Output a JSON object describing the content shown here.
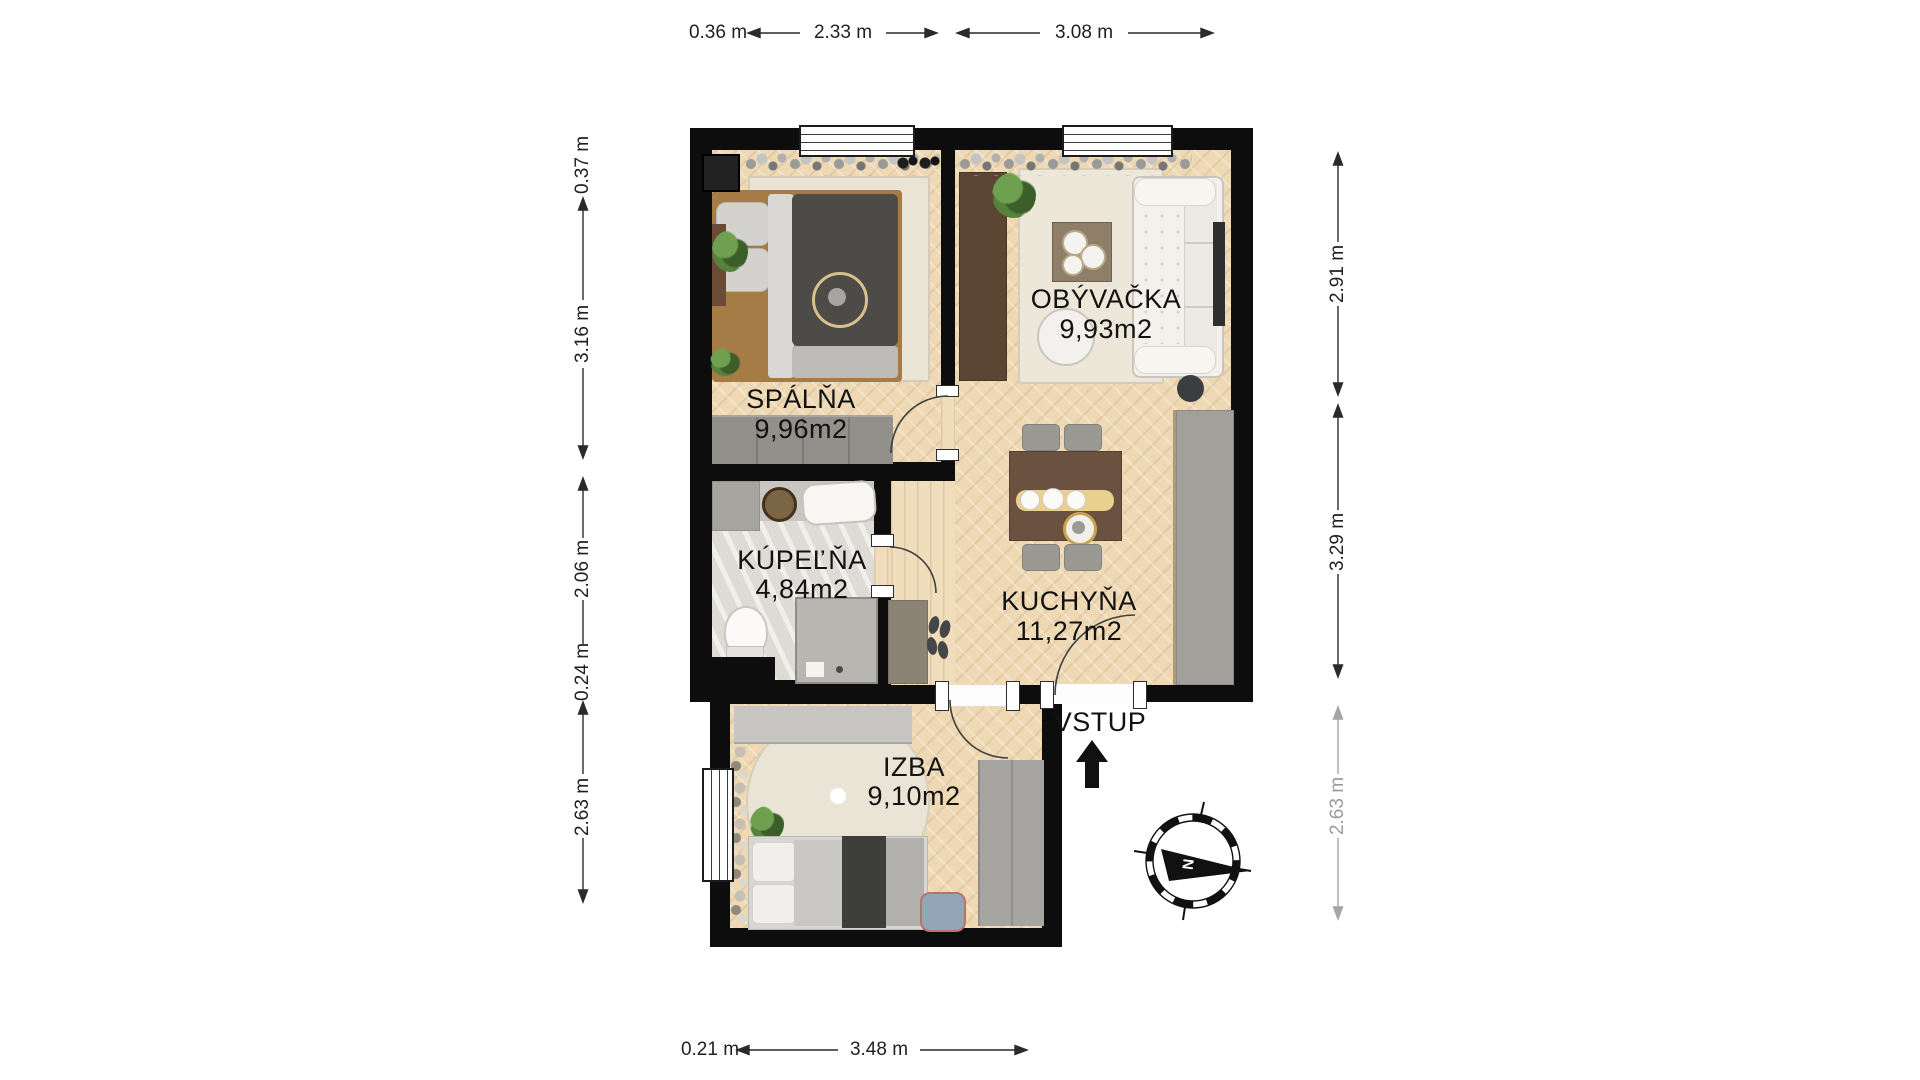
{
  "plan": {
    "rooms": [
      {
        "name": "SPÁLŇA",
        "area": "9,96m2"
      },
      {
        "name": "OBÝVAČKA",
        "area": "9,93m2"
      },
      {
        "name": "KÚPEĽŇA",
        "area": "4,84m2"
      },
      {
        "name": "KUCHYŇA",
        "area": "11,27m2"
      },
      {
        "name": "IZBA",
        "area": "9,10m2"
      }
    ],
    "entrance_label": "VSTUP",
    "compass": {
      "north_label": "N"
    }
  },
  "dimensions": {
    "top": [
      "0.36 m",
      "2.33 m",
      "3.08 m"
    ],
    "left": [
      "0.37 m",
      "3.16 m",
      "2.06 m",
      "0.24 m",
      "2.63 m"
    ],
    "right": [
      "2.91 m",
      "3.29 m",
      "2.63 m"
    ],
    "bottom": [
      "0.21 m",
      "3.48 m"
    ]
  },
  "colors": {
    "wall": "#0d0d0d",
    "floor_wood": "#eed9b4",
    "bathroom_tile": "#dedbd5",
    "accent_gold": "#d9c08c",
    "dim_gray": "#9b9b9b"
  }
}
